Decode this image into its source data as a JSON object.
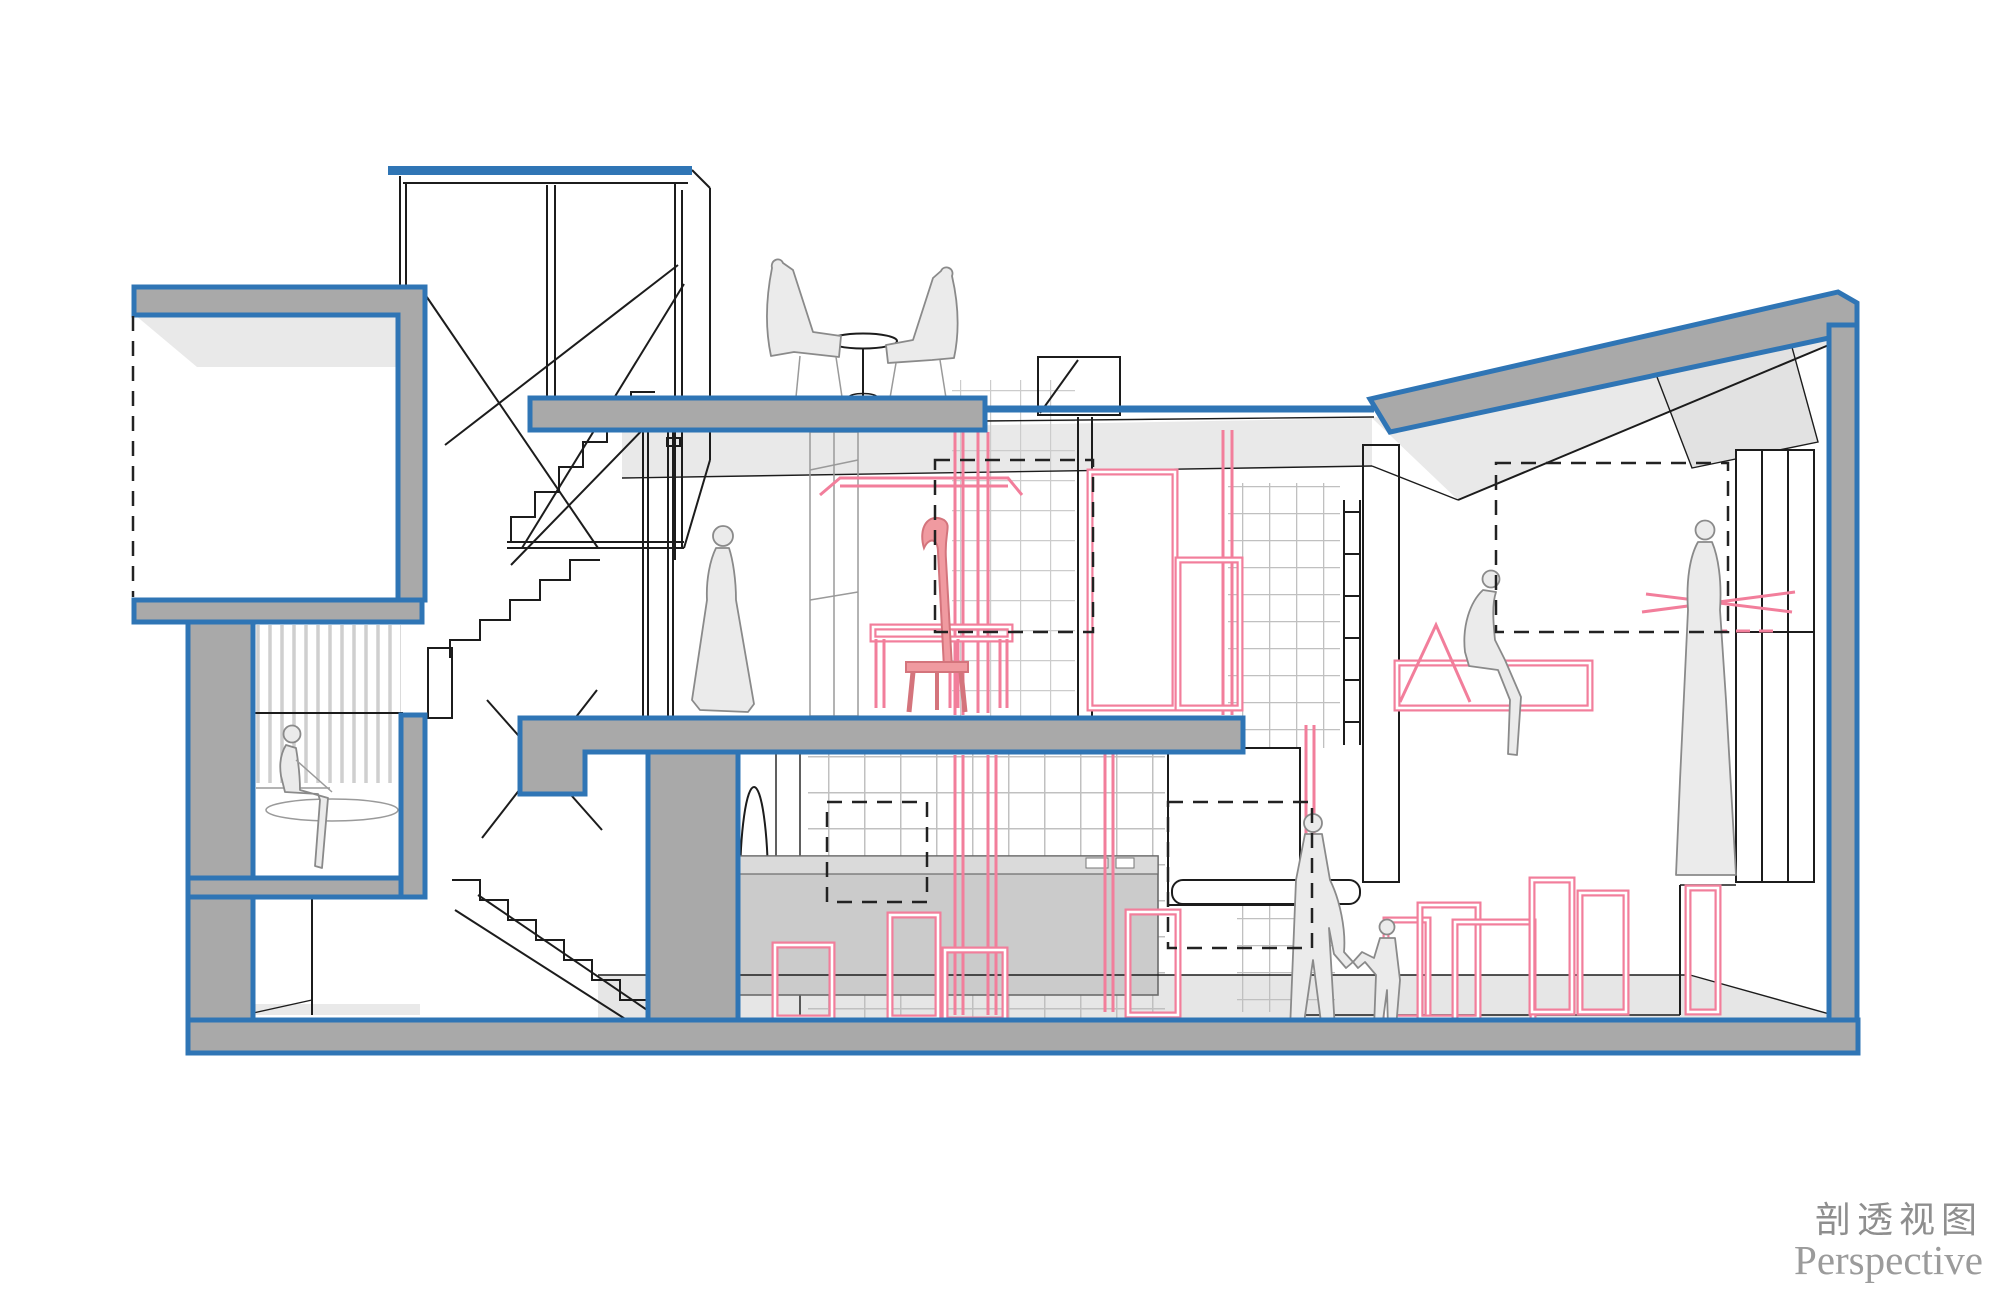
{
  "caption": {
    "zh": "剖透视图",
    "en": "Perspective"
  },
  "palette": {
    "cut_wall_blue": "#2f75b5",
    "cut_wall_gray": "#a9a9a9",
    "plane_light_gray": "#e9e9e9",
    "line_black": "#1c1c1c",
    "glassblock_gray": "#c0c0c0",
    "furniture_pink": "#f27e9b",
    "furniture_pink_solid": "#f09aa0",
    "figure_gray": "#ebebeb",
    "caption_gray": "#8e8e8e"
  },
  "scene": {
    "type": "architectural-section-perspective",
    "levels": [
      "basement",
      "ground-floor",
      "upper-floor",
      "roof-terrace"
    ],
    "figure_count": 8,
    "furniture_color_coding": "pink = proposed furniture, gray = fixed casework"
  }
}
